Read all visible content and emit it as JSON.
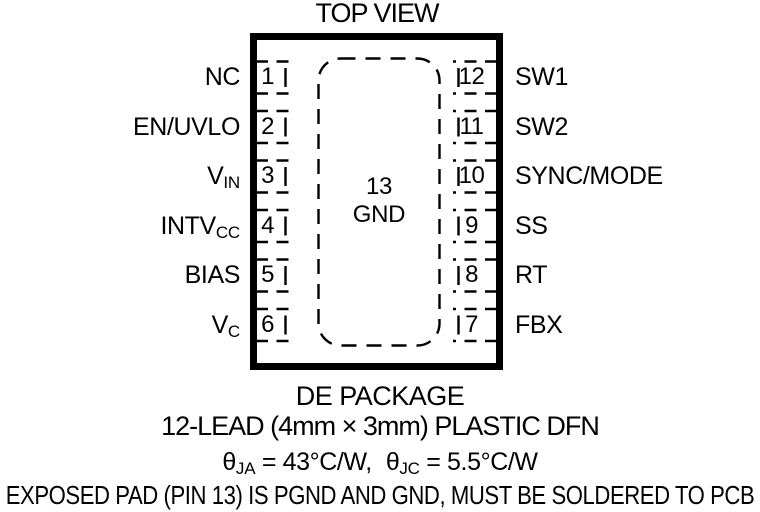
{
  "title": "TOP VIEW",
  "pins": {
    "left": [
      {
        "num": "1",
        "main": "NC",
        "sub": ""
      },
      {
        "num": "2",
        "main": "EN/UVLO",
        "sub": ""
      },
      {
        "num": "3",
        "main": "V",
        "sub": "IN"
      },
      {
        "num": "4",
        "main": "INTV",
        "sub": "CC"
      },
      {
        "num": "5",
        "main": "BIAS",
        "sub": ""
      },
      {
        "num": "6",
        "main": "V",
        "sub": "C"
      }
    ],
    "right": [
      {
        "num": "12",
        "main": "SW1",
        "sub": ""
      },
      {
        "num": "11",
        "main": "SW2",
        "sub": ""
      },
      {
        "num": "10",
        "main": "SYNC/MODE",
        "sub": ""
      },
      {
        "num": "9",
        "main": "SS",
        "sub": ""
      },
      {
        "num": "8",
        "main": "RT",
        "sub": ""
      },
      {
        "num": "7",
        "main": "FBX",
        "sub": ""
      }
    ]
  },
  "exposed_pad": {
    "num": "13",
    "name": "GND"
  },
  "footer": {
    "package_name": "DE PACKAGE",
    "package_desc": "12-LEAD (4mm × 3mm) PLASTIC DFN",
    "theta": {
      "sym1": "θ",
      "sub1": "JA",
      "val1": " = 43°C/W,",
      "sym2": "θ",
      "sub2": "JC",
      "val2": " = 5.5°C/W"
    },
    "note": "EXPOSED PAD (PIN 13) IS PGND AND GND, MUST BE SOLDERED TO PCB"
  },
  "colors": {
    "ink": "#000000",
    "background": "#ffffff"
  }
}
